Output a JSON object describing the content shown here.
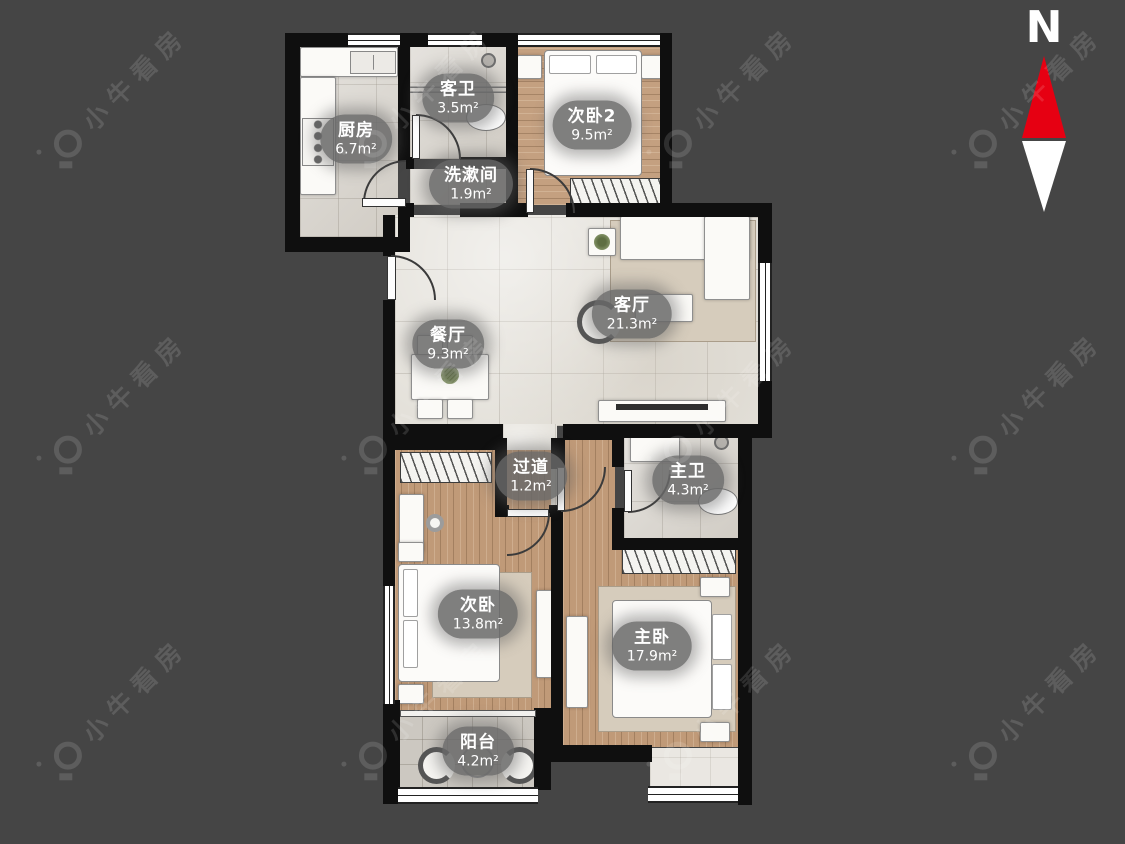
{
  "canvas": {
    "background": "#454545",
    "wall_color": "#0f0f0f"
  },
  "watermark": {
    "text": "小牛看房"
  },
  "compass": {
    "label": "N",
    "north_color": "#e60012",
    "south_color": "#ffffff"
  },
  "rooms": [
    {
      "id": "kitchen",
      "name": "厨房",
      "area": "6.7m²"
    },
    {
      "id": "guest-bath",
      "name": "客卫",
      "area": "3.5m²"
    },
    {
      "id": "bedroom2",
      "name": "次卧2",
      "area": "9.5m²"
    },
    {
      "id": "washroom",
      "name": "洗漱间",
      "area": "1.9m²"
    },
    {
      "id": "dining",
      "name": "餐厅",
      "area": "9.3m²"
    },
    {
      "id": "living",
      "name": "客厅",
      "area": "21.3m²"
    },
    {
      "id": "hallway",
      "name": "过道",
      "area": "1.2m²"
    },
    {
      "id": "master-bath",
      "name": "主卫",
      "area": "4.3m²"
    },
    {
      "id": "bedroom",
      "name": "次卧",
      "area": "13.8m²"
    },
    {
      "id": "master-bedroom",
      "name": "主卧",
      "area": "17.9m²"
    },
    {
      "id": "balcony",
      "name": "阳台",
      "area": "4.2m²"
    }
  ]
}
